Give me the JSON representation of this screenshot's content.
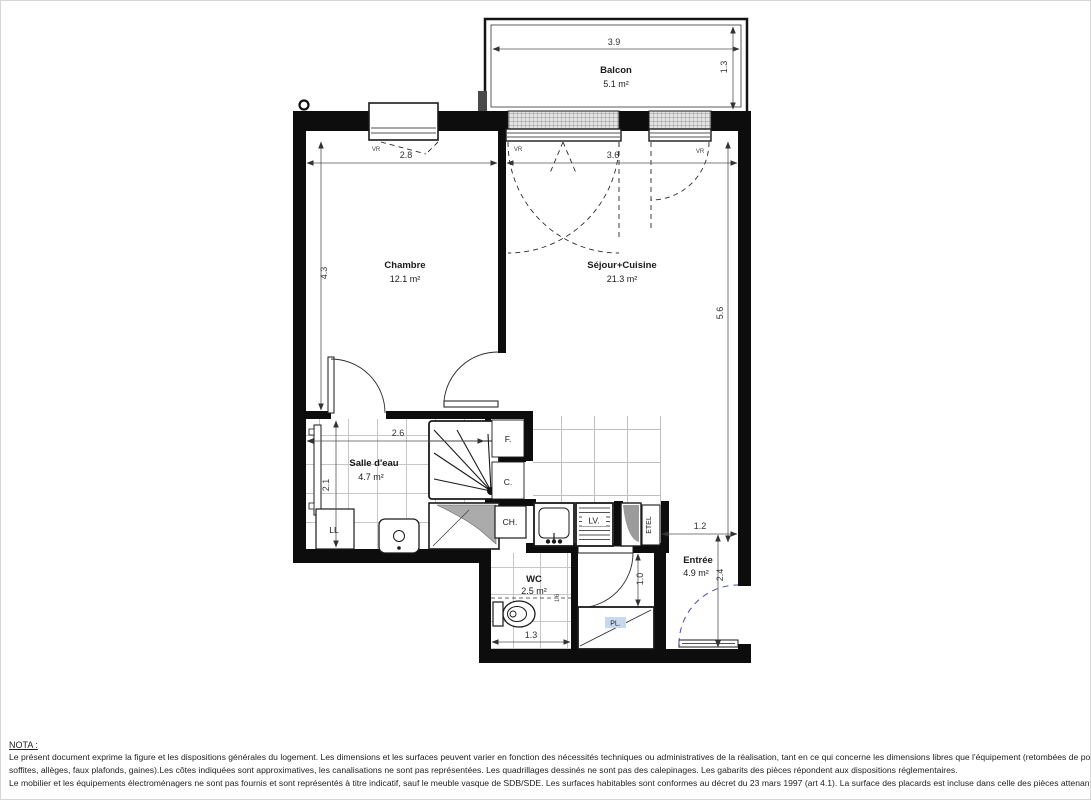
{
  "plan": {
    "balcon": {
      "name": "Balcon",
      "area": "5.1 m²",
      "width": "3.9",
      "depth": "1.3"
    },
    "chambre": {
      "name": "Chambre",
      "area": "12.1 m²",
      "width": "2.8",
      "height": "4.3",
      "shutter": "VR"
    },
    "sejour": {
      "name": "Séjour+Cuisine",
      "area": "21.3 m²",
      "width": "3.6",
      "height": "5.6",
      "shutter_left": "VR",
      "shutter_right": "VR"
    },
    "salle_eau": {
      "name": "Salle d'eau",
      "area": "4.7 m²",
      "width": "2.6",
      "height": "2.1",
      "washer": "LL"
    },
    "cuisine": {
      "fridge": "F.",
      "cooking": "C.",
      "boiler": "CH.",
      "dishwasher": "LV.",
      "duct": "ETEL"
    },
    "wc": {
      "name": "WC",
      "area": "2.5 m²",
      "width": "1.3",
      "height": "1.6"
    },
    "entree": {
      "name": "Entrée",
      "area": "4.9 m²",
      "width": "1.2",
      "height": "2.4",
      "hall_width": "1.0",
      "closet": "PL."
    }
  },
  "nota": {
    "title": "NOTA :",
    "line1": "Le présent document exprime la figure et les dispositions générales du logement. Les dimensions et les surfaces peuvent varier en fonction des nécessités techniques ou administratives de la réalisation, tant en ce qui concerne les dimensions libres que l'équipement (retombées de poutre,",
    "line2": "soffites, allèges, faux plafonds, gaines).Les côtes indiquées sont approximatives, les canalisations ne sont pas représentées. Les quadrillages dessinés ne sont pas des calepinages. Les gabarits des pièces répondent aux dispositions réglementaires.",
    "line3": "Le mobilier et les équipements électroménagers ne sont pas fournis et sont représentés à titre indicatif, sauf le meuble vasque de SDB/SDE. Les surfaces habitables sont conformes au décret du 23 mars 1997 (art 4.1). La surface des placards est incluse dans celle des pièces attenantes."
  }
}
